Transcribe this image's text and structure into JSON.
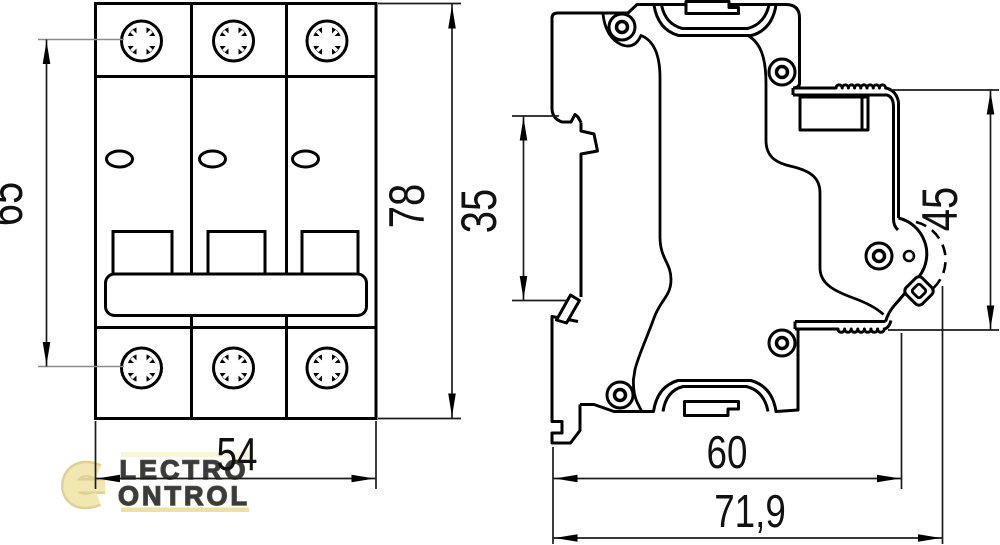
{
  "drawing": {
    "type": "technical-dimensional-drawing",
    "subject": "3-pole modular circuit breaker, front and side views",
    "line_color": "#000000",
    "dim_line_color": "#1c1c1c",
    "leader_color": "#8a8a8a",
    "dimensions": {
      "front_screw_span": "65",
      "front_total_height": "78",
      "front_width": "54",
      "side_din_channel": "35",
      "side_front_face": "45",
      "side_body_depth": "60",
      "side_total_depth": "71,9"
    }
  },
  "watermark": {
    "icon": "electrocontrol-e-logo",
    "line1": "LECTRO",
    "line2": "ONTROL",
    "fill": "#f2e9b0",
    "outline": "#2b2a20",
    "accent": "#e9dc8c",
    "pale": "#f7f3d0"
  }
}
